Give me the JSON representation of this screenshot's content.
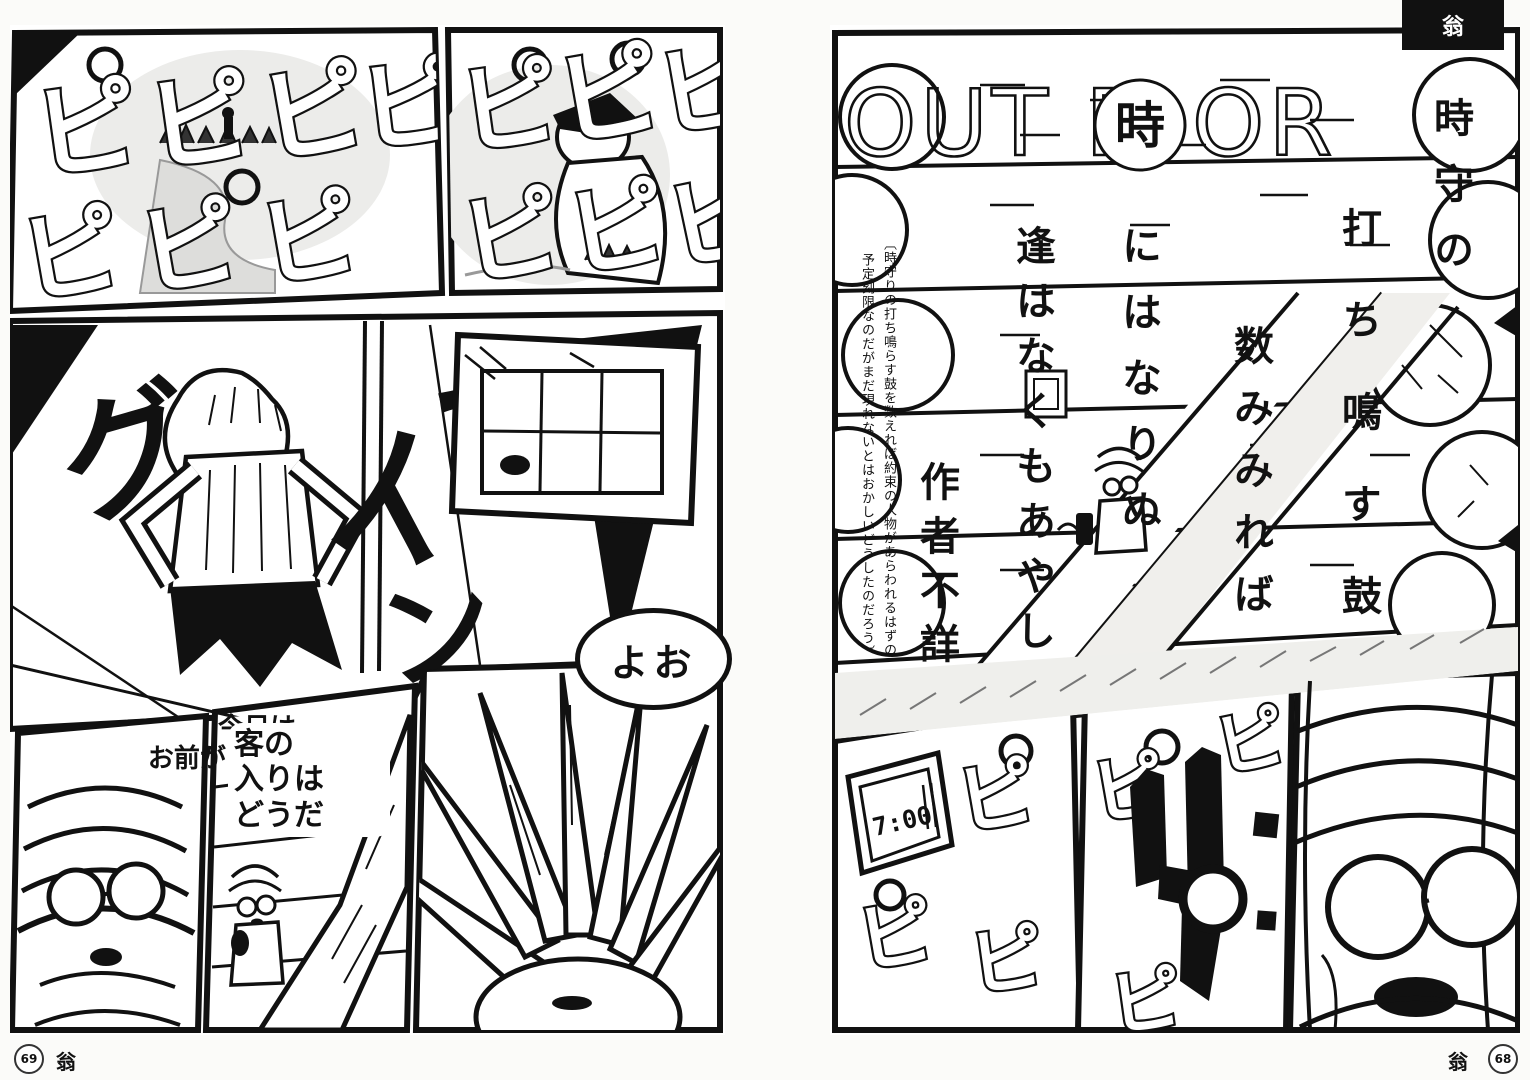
{
  "corner": {
    "label": "翁"
  },
  "footer": {
    "left": {
      "page_number": "69",
      "series_label": "翁"
    },
    "right": {
      "page_number": "68",
      "series_label": "翁"
    }
  },
  "sfx": {
    "beep": "ピ",
    "stretch": {
      "g1": "グ",
      "g2": "イ",
      "g3": "ー",
      "g4": "ン"
    }
  },
  "left_page": {
    "bubbles": {
      "yo": "よお",
      "today": {
        "line1": "今日は",
        "line2": "お前が1人目",
        "line3": "だ"
      },
      "customers": {
        "line1": "客の",
        "line2": "入りは",
        "line3": "どうだ"
      }
    }
  },
  "right_page": {
    "title": {
      "left": "OUT D",
      "circled": "時",
      "right": "OR"
    },
    "poem": {
      "col1": "時守の",
      "col2": "打ち鳴す鼓",
      "col3": "数みみれば",
      "col4": "にはなりぬ",
      "col5": "逢はなくもあやし",
      "author": "作者不詳"
    },
    "annotation": {
      "col1": "〔時守りの打ち鳴らす鼓を数えれば約束の人物があらわれるはずの",
      "col2": "予定刻限なのだがまだ現れないとはおかしいどうしたのだろう〕"
    },
    "clock_time": "7:00"
  }
}
